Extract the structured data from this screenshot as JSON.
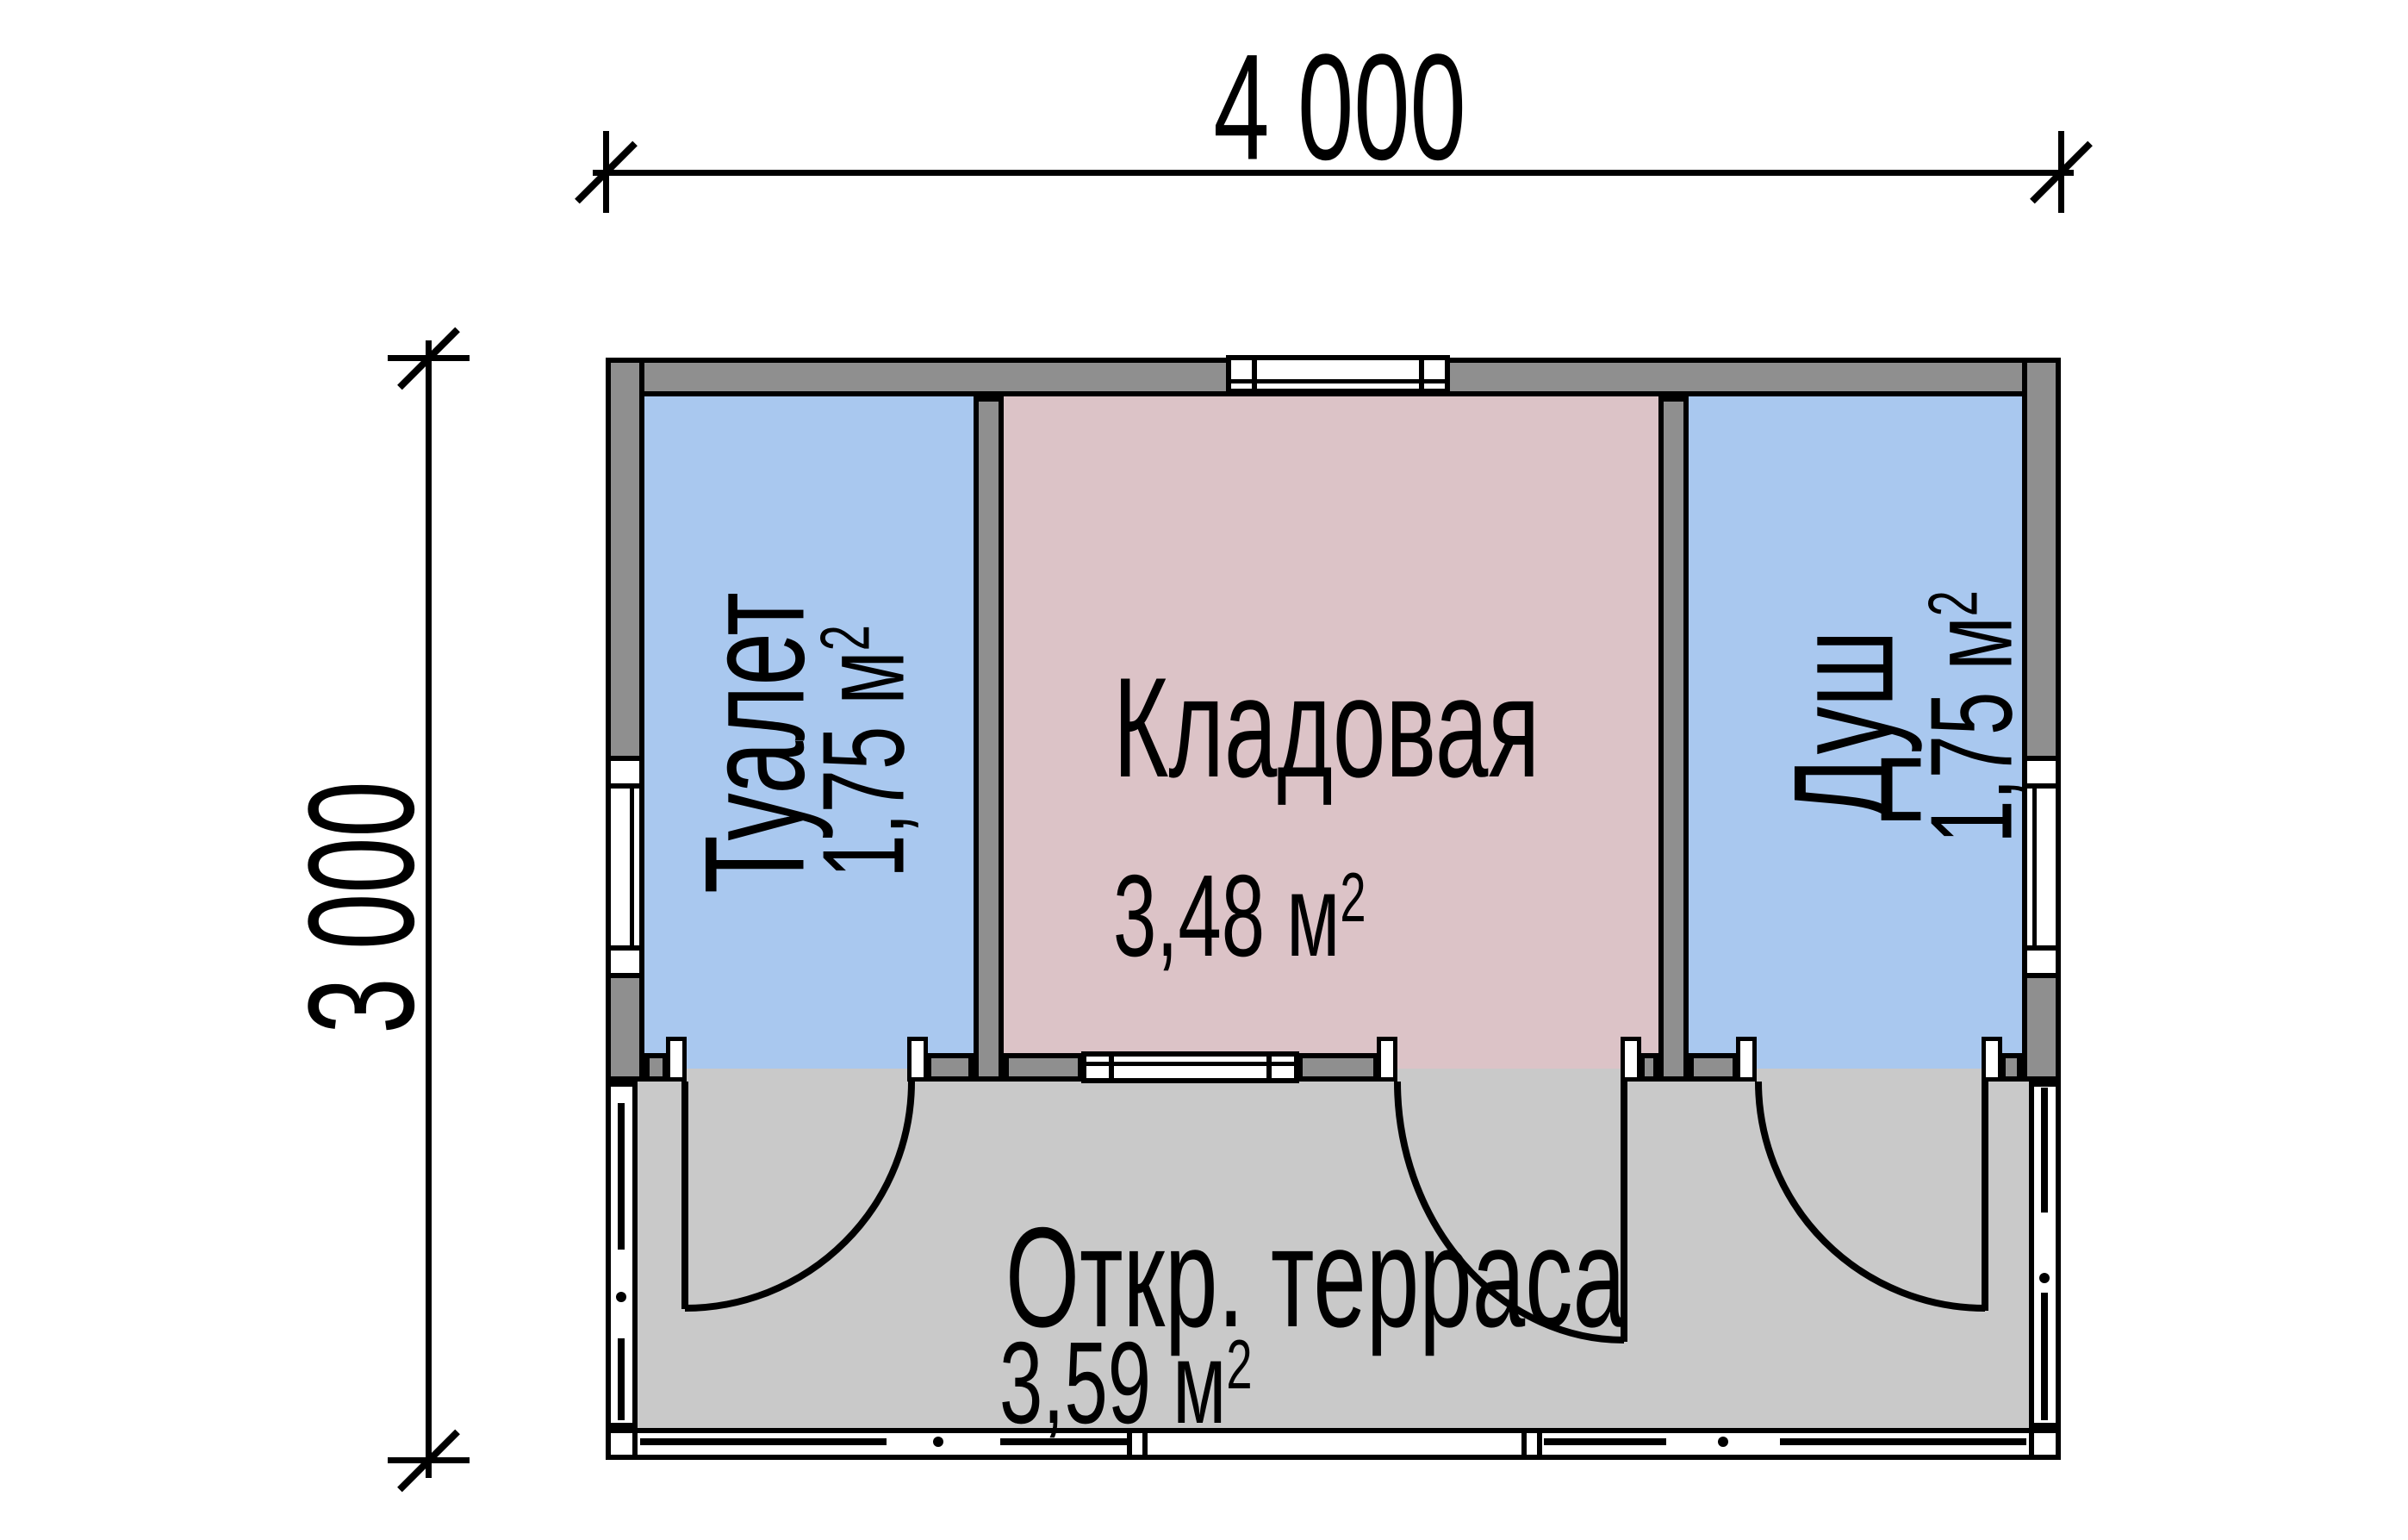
{
  "drawing": {
    "type": "floor-plan",
    "description": "Plan of a small garden building with toilet, storage room, shower and open terrace"
  },
  "dimensions": {
    "width_label": "4 000",
    "height_label": "3 000"
  },
  "rooms": [
    {
      "name": "Туалет",
      "area_value": "1,75 м",
      "area_sup": "2",
      "fill": "#a9c8ef"
    },
    {
      "name": "Кладовая",
      "area_value": "3,48 м",
      "area_sup": "2",
      "fill": "#dcc3c7"
    },
    {
      "name": "Душ",
      "area_value": "1,75 м",
      "area_sup": "2",
      "fill": "#a9c8ef"
    },
    {
      "name": "Откр. терраса",
      "area_value": "3,59 м",
      "area_sup": "2",
      "fill": "#c9c9c9"
    }
  ],
  "colors": {
    "wall": "#8f8f8f",
    "outline": "#000000",
    "room_blue": "#a9c8ef",
    "room_pink": "#dcc3c7",
    "terrace_floor": "#c9c9c9",
    "background": "#ffffff"
  }
}
